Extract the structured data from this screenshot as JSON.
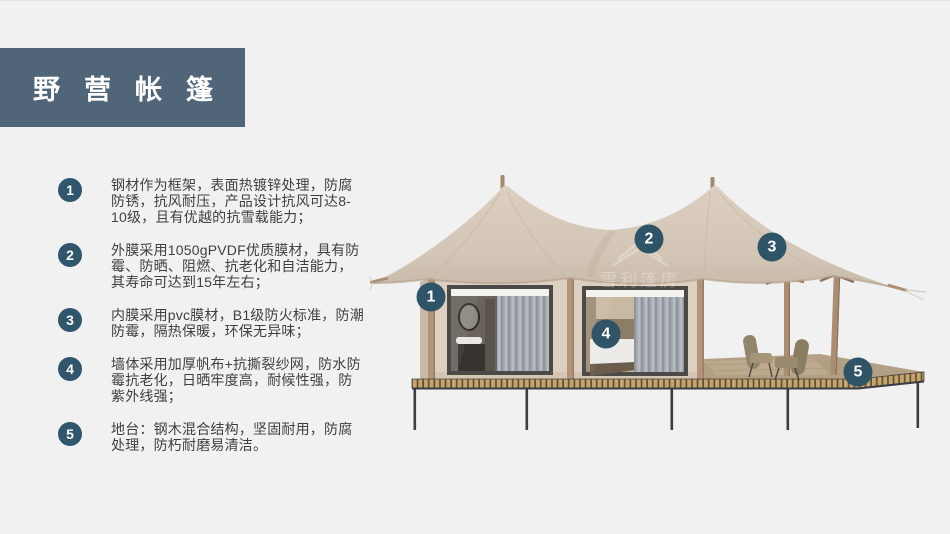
{
  "title": "野营帐篷",
  "features": [
    {
      "number": "1",
      "text": "钢材作为框架，表面热镀锌处理，防腐防锈，抗风耐压，产品设计抗风可达8-10级，且有优越的抗雪载能力；"
    },
    {
      "number": "2",
      "text": "外膜采用1050gPVDF优质膜材，具有防霉、防晒、阻燃、抗老化和自洁能力，其寿命可达到15年左右；"
    },
    {
      "number": "3",
      "text": "内膜采用pvc膜材，B1级防火标准，防潮防霉，隔热保暖，环保无异味；"
    },
    {
      "number": "4",
      "text": "墙体采用加厚帆布+抗撕裂纱网，防水防霉抗老化，日晒牢度高，耐候性强，防紫外线强；"
    },
    {
      "number": "5",
      "text": "地台：钢木混合结构，坚固耐用，防腐处理，防朽耐磨易清洁。"
    }
  ],
  "illustration": {
    "badges": [
      "1",
      "2",
      "3",
      "4",
      "5"
    ],
    "watermark": "雪利篷房"
  },
  "colors": {
    "background": "#f1f1f2",
    "title_block": "#516579",
    "number_badge": "#30566b",
    "body_text": "#3f3f3f",
    "roof_fabric": "#d3c6b7",
    "wall_fabric": "#ded0c0",
    "wood": "#b3947b",
    "deck_plank": "#c9a464",
    "steel_frame": "#3a3e44"
  }
}
